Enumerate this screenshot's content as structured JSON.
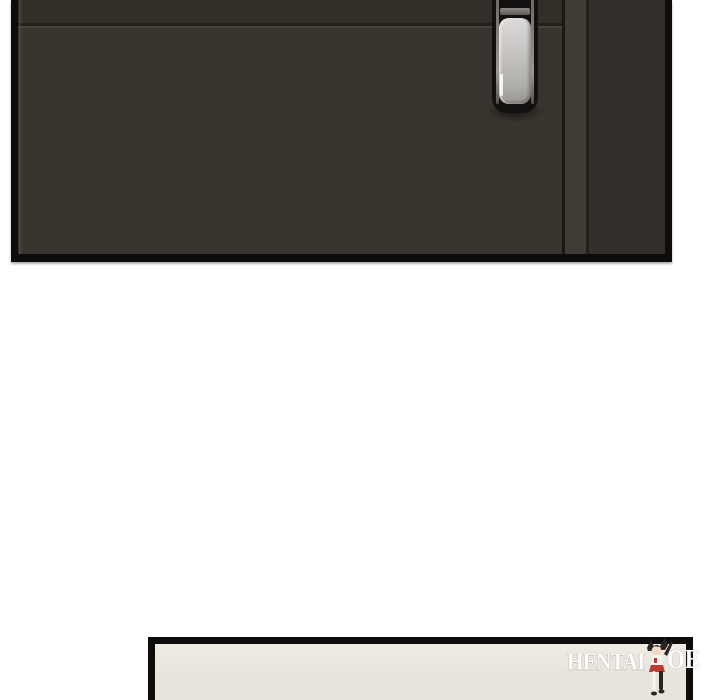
{
  "page": {
    "background_color": "#ffffff",
    "description": "webtoon comic page: dark door panel, white gutter, start of next panel"
  },
  "panels": {
    "top_door_panel": {
      "border_color": "#0d0c0a",
      "door_color": "#37332d",
      "door_top_strip_color": "#322e28",
      "groove_dark_color": "#221f1a",
      "groove_light_color": "#48433a",
      "gap_line_color": "#1b1814",
      "frame_strip_color": "#3f3b35",
      "frame_edge_color": "#23201b",
      "right_section_color": "#342f2a",
      "handle": {
        "plate_color": "#131110",
        "metal_color_top": "#dcdbd9",
        "metal_color_bottom": "#9a9895",
        "chrome_edge_color": "#9a9793"
      }
    },
    "bottom_panel": {
      "border_color": "#0d0c0a",
      "fill_color": "#e9e4db"
    }
  },
  "watermark": {
    "text_left": "HENTAI",
    "text_right": "OE",
    "text_color": "#ffffff",
    "figure_icon": "chibi-girl-watermark-figure",
    "figure_colors": {
      "hair": "#2b2420",
      "skin": "#f1d9c4",
      "outfit_white": "#f7f4ef",
      "outfit_red": "#b93a36",
      "legs_dark": "#2b2420"
    }
  }
}
